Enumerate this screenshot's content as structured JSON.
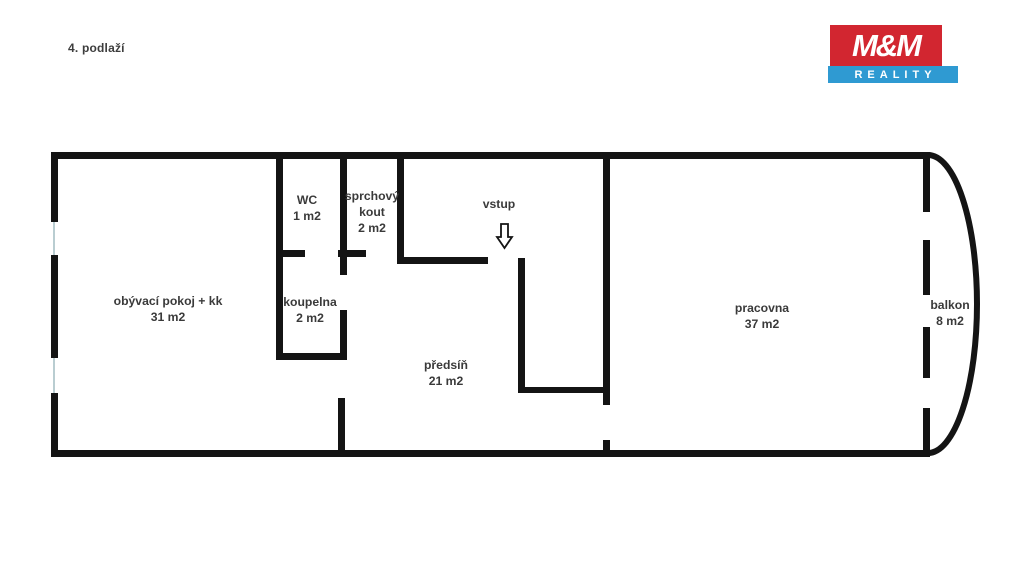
{
  "page": {
    "title": "4. podlaží",
    "background": "#ffffff"
  },
  "logo": {
    "line1": "M&M",
    "line2": "REALITY",
    "red": "#d22630",
    "blue": "#2f9ad2",
    "text_color": "#ffffff"
  },
  "floorplan": {
    "wall_color": "#141414",
    "window_color": "#b9cdd1",
    "label_color": "#3a3a3a",
    "line_height": 16,
    "walls": [
      {
        "name": "outer-top",
        "x": 51,
        "y": 152,
        "w": 879,
        "h": 7
      },
      {
        "name": "outer-left-upper",
        "x": 51,
        "y": 152,
        "w": 7,
        "h": 70
      },
      {
        "name": "outer-left-middle",
        "x": 51,
        "y": 255,
        "w": 7,
        "h": 103
      },
      {
        "name": "outer-left-lower",
        "x": 51,
        "y": 393,
        "w": 7,
        "h": 64
      },
      {
        "name": "outer-bottom",
        "x": 51,
        "y": 450,
        "w": 879,
        "h": 7
      },
      {
        "name": "living-bath-divider",
        "x": 276,
        "y": 152,
        "w": 7,
        "h": 206
      },
      {
        "name": "wc-shower-divider",
        "x": 340,
        "y": 152,
        "w": 7,
        "h": 123
      },
      {
        "name": "shower-hall-divider",
        "x": 397,
        "y": 152,
        "w": 7,
        "h": 111
      },
      {
        "name": "wc-bottom-left",
        "x": 276,
        "y": 250,
        "w": 29,
        "h": 7
      },
      {
        "name": "shower-bottom-left",
        "x": 338,
        "y": 250,
        "w": 28,
        "h": 7
      },
      {
        "name": "hall-top",
        "x": 397,
        "y": 257,
        "w": 91,
        "h": 7
      },
      {
        "name": "entry-nook-left",
        "x": 518,
        "y": 258,
        "w": 7,
        "h": 135
      },
      {
        "name": "entry-nook-bottom",
        "x": 518,
        "y": 387,
        "w": 92,
        "h": 6
      },
      {
        "name": "hall-study-divider",
        "x": 603,
        "y": 152,
        "w": 7,
        "h": 253
      },
      {
        "name": "hall-study-stub",
        "x": 603,
        "y": 440,
        "w": 7,
        "h": 17
      },
      {
        "name": "bath-right",
        "x": 340,
        "y": 310,
        "w": 7,
        "h": 50
      },
      {
        "name": "bath-bottom",
        "x": 276,
        "y": 353,
        "w": 71,
        "h": 7
      },
      {
        "name": "living-hall-divider",
        "x": 338,
        "y": 398,
        "w": 7,
        "h": 59
      }
    ],
    "windows": [
      {
        "name": "living-window-upper",
        "x": 53,
        "y": 222,
        "w": 2,
        "h": 33
      },
      {
        "name": "living-window-lower",
        "x": 53,
        "y": 358,
        "w": 2,
        "h": 35
      }
    ],
    "balcony_dashes": {
      "x": 923,
      "w": 7,
      "segments": [
        {
          "y": 152,
          "h": 60
        },
        {
          "y": 240,
          "h": 55
        },
        {
          "y": 327,
          "h": 51
        },
        {
          "y": 408,
          "h": 49
        }
      ]
    },
    "balcony_curve": {
      "path": "M 928 155 A 49 149 0 0 1 928 453",
      "stroke_width": 6
    },
    "entrance_arrow": {
      "path": "M 501 224 L 508 224 L 508 237 L 512 237 L 504.5 248 L 497 237 L 501 237 Z",
      "fill": "#ffffff",
      "stroke": "#141414"
    },
    "rooms": [
      {
        "id": "obyvaci-pokoj",
        "lines": [
          "obývací pokoj + kk",
          "31 m2"
        ],
        "x": 168,
        "y": 305
      },
      {
        "id": "wc",
        "lines": [
          "WC",
          "1 m2"
        ],
        "x": 307,
        "y": 204
      },
      {
        "id": "sprchovy-kout",
        "lines": [
          "sprchový",
          "kout",
          "2 m2"
        ],
        "x": 372,
        "y": 200
      },
      {
        "id": "vstup",
        "lines": [
          "vstup"
        ],
        "x": 499,
        "y": 208
      },
      {
        "id": "koupelna",
        "lines": [
          "koupelna",
          "2 m2"
        ],
        "x": 310,
        "y": 306
      },
      {
        "id": "predsin",
        "lines": [
          "předsíň",
          "21 m2"
        ],
        "x": 446,
        "y": 369
      },
      {
        "id": "pracovna",
        "lines": [
          "pracovna",
          "37 m2"
        ],
        "x": 762,
        "y": 312
      },
      {
        "id": "balkon",
        "lines": [
          "balkon",
          "8 m2"
        ],
        "x": 950,
        "y": 309
      }
    ]
  }
}
